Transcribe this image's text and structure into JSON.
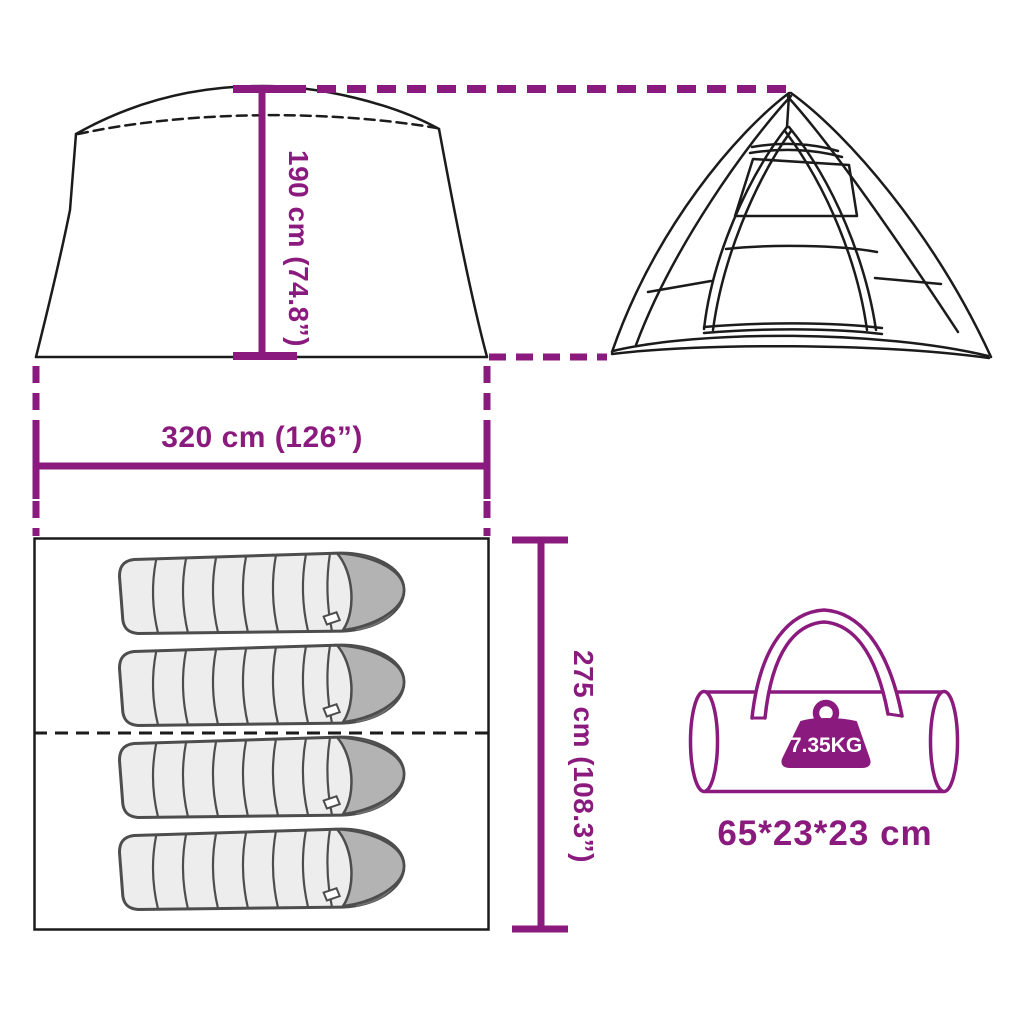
{
  "diagram": {
    "type": "product-dimension-diagram",
    "background": "#FFFFFF",
    "labels": {
      "height": "190 cm (74.8”)",
      "width": "320 cm (126”)",
      "depth": "275 cm (108.3”)",
      "bag_weight": "7.35KG",
      "bag_size": "65*23*23 cm"
    },
    "values": {
      "height_cm": 190,
      "height_inch": 74.8,
      "width_cm": 320,
      "width_inch": 126,
      "depth_cm": 275,
      "depth_inch": 108.3,
      "weight_kg": 7.35,
      "carry_bag_dimensions_cm": "65*23*23",
      "sleeping_bag_count": 4
    },
    "icons": [
      "tent-side-view",
      "tent-front-view",
      "floor-plan",
      "sleeping-bag-icon",
      "carry-bag-icon",
      "weight-icon"
    ],
    "colors": {
      "accent_purple": "#8B1A7E",
      "line_black": "#1B1B1B",
      "sleeping_bag_fill": "#EDEDED",
      "sleeping_bag_head": "#B3B3B3",
      "sleeping_bag_outline": "#4D4D4D",
      "weight_label_text": "#FFFFFF"
    }
  }
}
